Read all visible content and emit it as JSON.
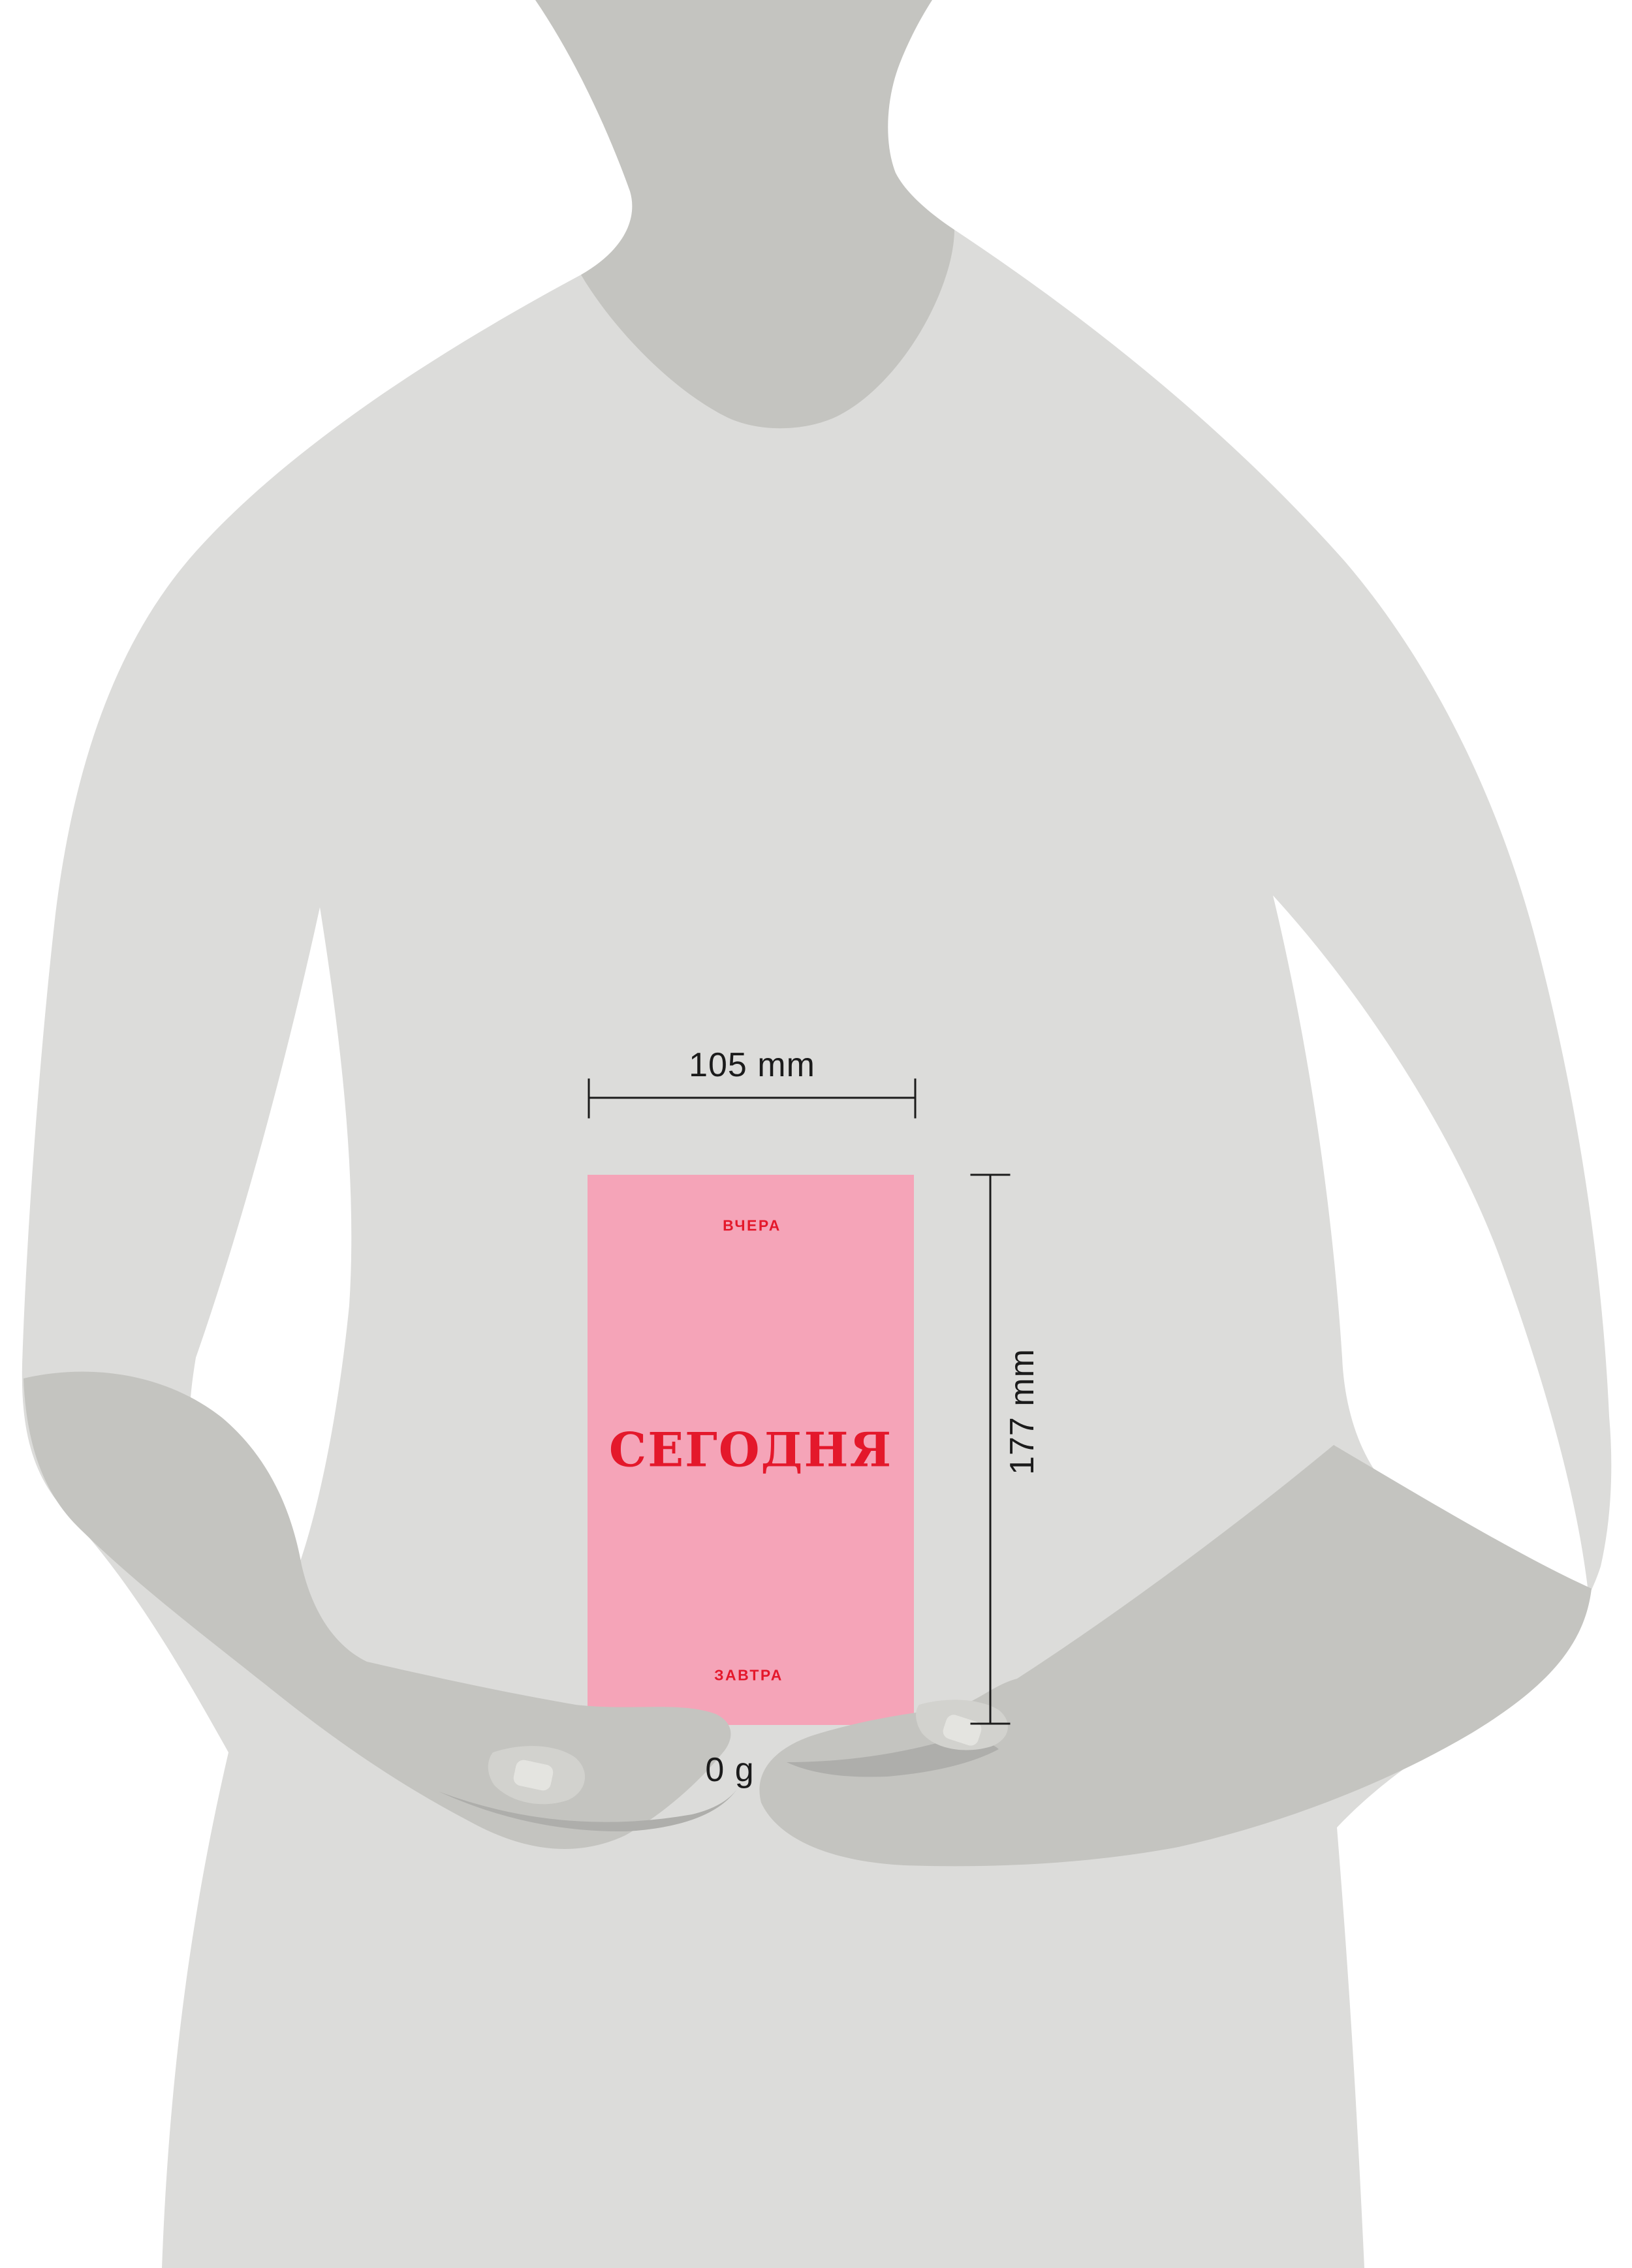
{
  "illustration": {
    "description": "Gray human silhouette holding a pink booklet against the belly, with printed size and weight dimensions",
    "booklet": {
      "top_label": "ВЧЕРА",
      "title": "СЕГОДНЯ",
      "bottom_label": "ЗАВТРА"
    },
    "dimensions": {
      "width_label": "105 mm",
      "height_label": "177 mm",
      "weight_label": "0 g"
    },
    "colors": {
      "background": "#ffffff",
      "body_gray": "#dcdcda",
      "shadow_gray": "#c4c4c0",
      "highlight_gray": "#d2d2ce",
      "nail_gray": "#e4e4e0",
      "crease_gray": "#aeaeab",
      "card_pink": "#f5a4b8",
      "accent_red": "#e4182b",
      "line_black": "#1b1b1b"
    }
  }
}
